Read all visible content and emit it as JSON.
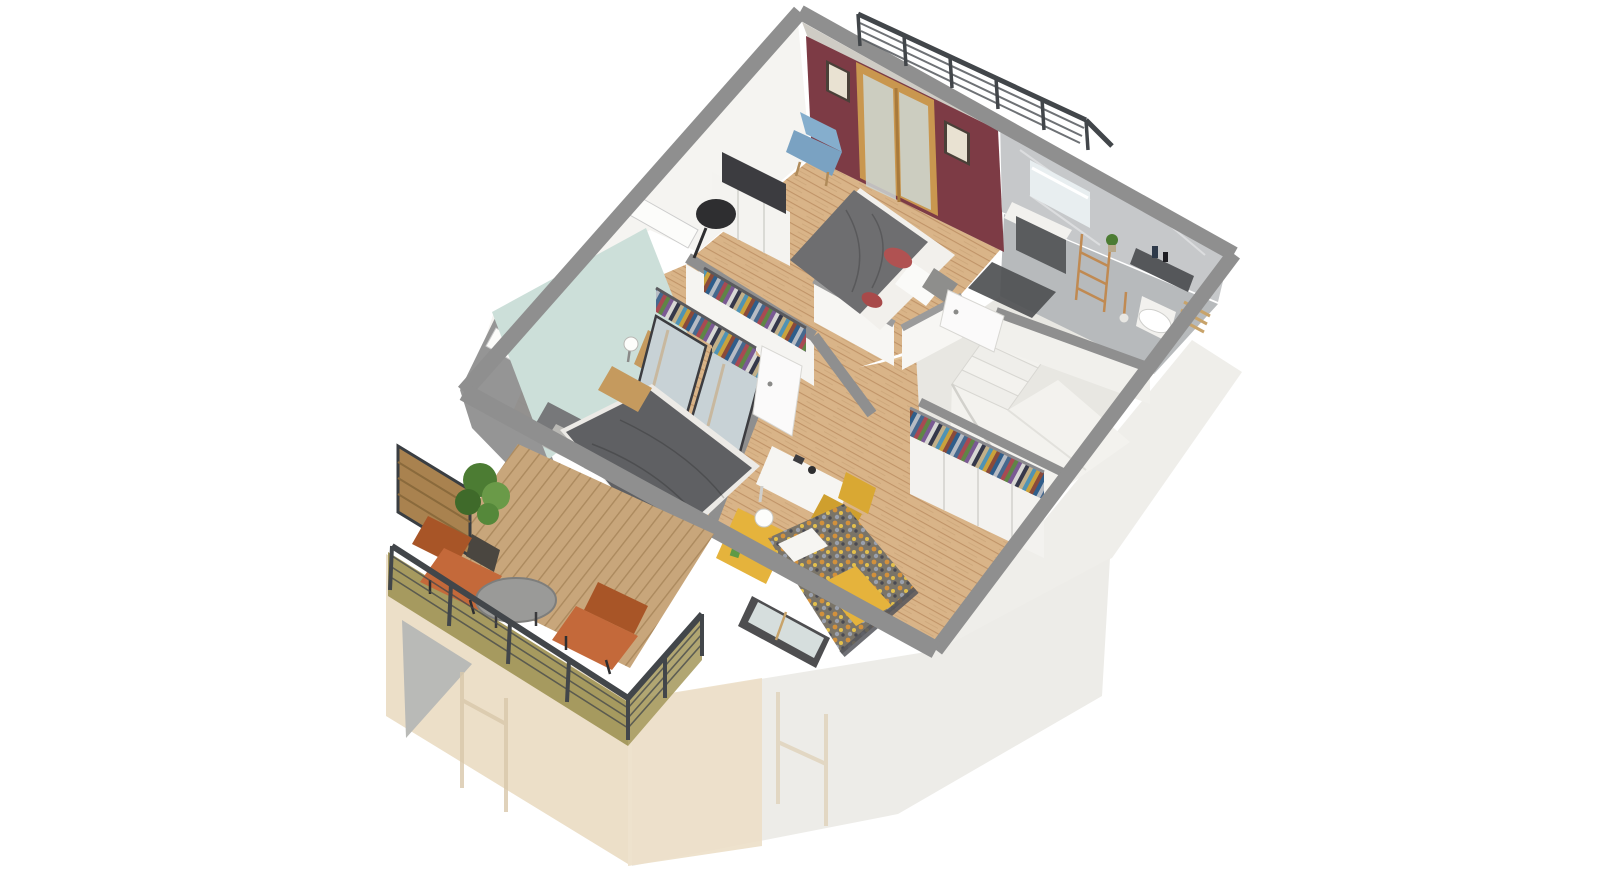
{
  "scene": {
    "type": "isometric-3d-floor-plan-cutaway-render",
    "view": "upper floor cutaway with furnished rooms; lower floor shown as faded ghost volume",
    "rooms": [
      {
        "name": "master-bedroom",
        "accent_wall": "maroon",
        "floor": "wood",
        "furniture": [
          "double-bed-gray-duvet",
          "red-pillows",
          "white-pillows",
          "tv-sideboard",
          "flat-screen-tv",
          "black-shade-floor-lamp",
          "blue-accent-chair",
          "framed-picture-left",
          "framed-picture-right",
          "glazed-wood-double-doors-to-terrace",
          "open-clothes-rack",
          "wood-storage-box"
        ]
      },
      {
        "name": "bedroom-2",
        "accent_wall": "mint-teal",
        "floor": "wood",
        "furniture": [
          "double-bed-dark-striped-duvet",
          "gray-headboard-cushions",
          "gray-pillows",
          "wood-nightstand",
          "ball-table-lamp",
          "mirrored-sliding-wardrobe",
          "open-clothes-rack",
          "skylight-recess",
          "skylight-recess-2"
        ]
      },
      {
        "name": "kids-bedroom",
        "floor": "wood",
        "furniture": [
          "single-bed-camo-pattern-duvet",
          "yellow-throw-blanket",
          "white-pillow",
          "yellow-headboard-shelf",
          "globe-lamp",
          "toy-figure",
          "white-desk",
          "desk-accessories",
          "yellow-swivel-chair",
          "wardrobe-open-clothes-top",
          "white-cabinet-row",
          "glazed-window"
        ]
      },
      {
        "name": "bathroom",
        "walls": "gray-marble",
        "floor": "gray-marble",
        "furniture": [
          "vanity-mirror",
          "dark-vanity-cabinet-with-sink",
          "copper-towel-ladder",
          "dark-bath-mat",
          "wall-hung-toilet",
          "cistern-shelf-with-bottles",
          "small-plant",
          "wood-slat-bench",
          "toilet-brush"
        ]
      },
      {
        "name": "stair-landing",
        "floor": "light-tile",
        "furniture": [
          "winder-staircase",
          "stair-half-walls",
          "white-door-hall",
          "white-door-bathroom"
        ]
      },
      {
        "name": "balcony-terrace",
        "floor": "wood-deck",
        "furniture": [
          "orange-lounge-chair-1",
          "orange-lounge-chair-2",
          "round-gray-coffee-table",
          "potted-plant",
          "wood-privacy-screen",
          "metal-cable-railing",
          "glazed-wood-balcony-door"
        ]
      },
      {
        "name": "roof-terrace",
        "furniture": [
          "dark-slat-guard-railing"
        ]
      }
    ],
    "ghost_lower_floor": {
      "left_walls": "beige",
      "right_walls": "white",
      "details": [
        "faded-window-frames",
        "gray-roof-gable"
      ]
    }
  },
  "colors": {
    "background": "#ffffff",
    "wall_top_gray": "#8f8f8f",
    "wall_top_light": "#9b9b9b",
    "interior_wall_white": "#f5f4f1",
    "terrace_sliver": "#cfccc5",
    "maroon_wall": "#7d3b45",
    "teal_wall": "#ccdfd9",
    "wood_floor": "#d9b488",
    "wood_plank_line": "#c09468",
    "hall_wood": "#e2c295",
    "marble_wall": "#c6c8ca",
    "marble_floor": "#b7babc",
    "tile_floor": "#e8e7e2",
    "stairs_white": "#f3f2ee",
    "ghost_beige": "#ecdfc8",
    "ghost_white": "#edece8",
    "ghost_roof_gray": "#b9bab7",
    "deck_wood": "#c8a67b",
    "deck_line": "#ac8a5e",
    "khaki_fascia": "#a69a5f",
    "railing_dark": "#42464a",
    "screen_wood": "#a9824f",
    "plant_green": "#4c7c33",
    "plant_green_light": "#6a9a48",
    "pot_dark": "#4a4640",
    "orange_chair": "#c4693a",
    "orange_chair_dark": "#a85527",
    "table_gray": "#9a9a98",
    "master_bed_duvet": "#6e6e70",
    "master_bed_sheet": "#f2f0ec",
    "red_pillow": "#b05252",
    "gray_pillow": "#8e8e8c",
    "blue_chair": "#85aecd",
    "tv_dark": "#3c3c40",
    "tv_unit_white": "#f4f3f0",
    "lamp_black": "#2e2e30",
    "door_wood": "#c9974f",
    "door_glass": "#ccd6d4",
    "picture_frame": "#4a4038",
    "picture_mat": "#e9e2d2",
    "bed2_duvet": "#5f6063",
    "headboard_gray": "#77787a",
    "pillow_light": "#b9b8b4",
    "nightstand_wood": "#c59a5e",
    "mirror_glass": "#c8d2d6",
    "kids_bed_base": "#7a7468",
    "kids_yellow": "#e5b33c",
    "desk_white": "#f6f5f2",
    "chair_yellow": "#d9a833",
    "toilet_white": "#f2f1ee",
    "vanity_dark": "#5a5c5e",
    "copper": "#c08a52",
    "mat_dark": "#4e5052",
    "door_white": "#fbfafa",
    "window_frame_dark": "#4e4e50",
    "window_glass": "#d6dedd"
  },
  "palettes": {
    "clothes": [
      "#46688e",
      "#a84a52",
      "#5f8546",
      "#7a5a93",
      "#d8d8d4",
      "#35384a",
      "#c2b089",
      "#4f93b5",
      "#caa23c",
      "#8a4a3a",
      "#2f5d8a",
      "#b7bcc4"
    ],
    "kids_pattern": [
      "#d2913c",
      "#e3c04c",
      "#9aa0ac",
      "#4a4a52"
    ]
  }
}
